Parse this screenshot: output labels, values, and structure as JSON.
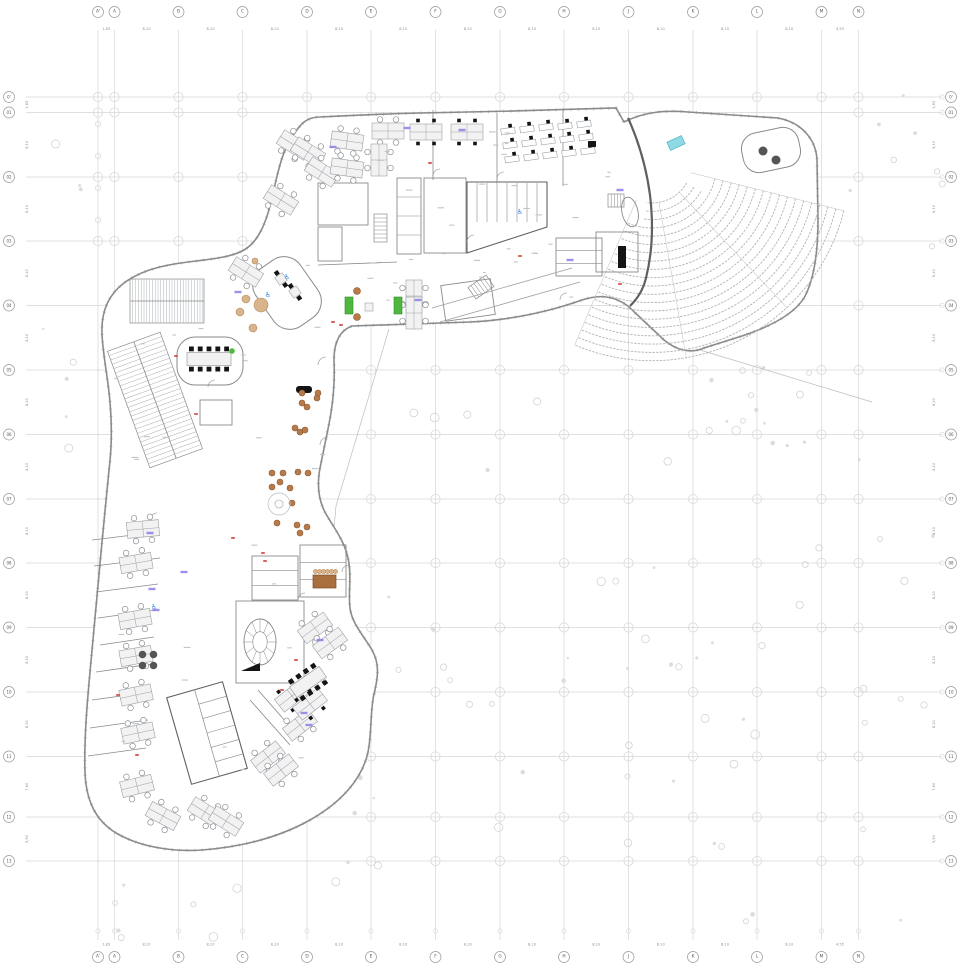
{
  "meta": {
    "drawing_type": "architectural floor plan"
  },
  "canvas": {
    "width": 960,
    "height": 965,
    "background": "#ffffff"
  },
  "colors": {
    "grid_line": "#d6d6d6",
    "grid_bubble_stroke": "#999999",
    "grid_text": "#555555",
    "dim_text": "#8f8f8f",
    "wall": "#8a8a8a",
    "wall_heavy": "#606060",
    "furniture_stroke": "#9aa0a6",
    "furniture_fill": "#f2f2f2",
    "black": "#141414",
    "seat_row": "#aeb4ba",
    "tick": "#909090",
    "site_dot": "#d3d3d3",
    "ring": "#d8d8d8",
    "sofa_green": "#4fb63f",
    "plant_green": "#4fb63f",
    "stage_cyan": "#8fd9e4",
    "stage_cyan_stroke": "#4ab5c4",
    "stool_brown": "#b97a4a",
    "stool_brown_stroke": "#8a5a33",
    "tan": "#d9b38c",
    "table_brown": "#a96f3d",
    "wheelchair_blue": "#2e86de",
    "label_blue": "#8a7fe8",
    "red_mark": "#d23b2f",
    "annotation": "#c3c3c3",
    "dark_circle": "#555555"
  },
  "grid": {
    "columns": {
      "labels": [
        "A'",
        "A",
        "B",
        "C",
        "D",
        "E",
        "F",
        "G",
        "H",
        "J",
        "K",
        "L",
        "M",
        "N"
      ],
      "x": [
        98,
        114.5,
        178.5,
        242.5,
        307,
        371,
        435.5,
        500,
        564,
        628.5,
        693,
        757,
        821.5,
        858.5
      ],
      "dims": [
        "1,83",
        "8,10",
        "8,10",
        "8,10",
        "8,10",
        "8,10",
        "8,10",
        "8,10",
        "8,10",
        "8,10",
        "8,10",
        "8,10",
        "4,55"
      ]
    },
    "rows": {
      "labels": [
        "0'",
        "01",
        "02",
        "03",
        "04",
        "05",
        "06",
        "07",
        "08",
        "09",
        "10",
        "11",
        "12",
        "13"
      ],
      "y": [
        97,
        112.5,
        177,
        241,
        305.5,
        370,
        434.5,
        499,
        563,
        627.5,
        692,
        756.5,
        817,
        861
      ],
      "dims": [
        "1,83",
        "8,10",
        "8,10",
        "8,10",
        "8,10",
        "8,10",
        "8,10",
        "8,10",
        "8,10",
        "8,10",
        "8,10",
        "7,60",
        "5,50"
      ]
    }
  },
  "auditorium": {
    "cx": 652,
    "cy": 163,
    "rows": 20,
    "r0": 40,
    "dr": 8.3,
    "a0": 14,
    "a1": 113,
    "a0_inner": 30,
    "a1_inner": 98,
    "aisle_angles": [
      14,
      47,
      80,
      113
    ]
  },
  "stage": {
    "x": 676,
    "y": 143,
    "w": 16,
    "h": 9,
    "rot": -25
  },
  "lobe_circles_dark": [
    [
      763,
      151,
      4.5
    ],
    [
      776,
      160,
      4.5
    ]
  ],
  "furniture": {
    "quad_circle": [
      [
        294,
        145,
        32
      ],
      [
        281,
        200,
        32
      ],
      [
        308,
        152,
        32
      ],
      [
        322,
        172,
        32
      ],
      [
        347,
        141,
        8
      ],
      [
        347,
        168,
        8
      ],
      [
        388,
        131,
        0
      ],
      [
        379,
        160,
        90
      ],
      [
        414,
        296,
        90
      ],
      [
        414,
        313,
        90
      ],
      [
        246,
        272,
        32
      ],
      [
        143,
        529,
        -5
      ],
      [
        136,
        563,
        -10
      ],
      [
        135,
        619,
        -10
      ],
      [
        136,
        656,
        -10
      ],
      [
        136,
        695,
        -12
      ],
      [
        138,
        733,
        -12
      ],
      [
        137,
        786,
        -14
      ],
      [
        163,
        816,
        28
      ],
      [
        205,
        812,
        32
      ],
      [
        226,
        821,
        32
      ],
      [
        315,
        628,
        -36
      ],
      [
        330,
        643,
        -36
      ],
      [
        300,
        725,
        -38
      ],
      [
        268,
        757,
        -38
      ],
      [
        281,
        770,
        -38
      ]
    ],
    "quad_black": [
      [
        426,
        132,
        0
      ],
      [
        467,
        132,
        0
      ],
      [
        292,
        696,
        -38
      ],
      [
        310,
        704,
        -38
      ]
    ],
    "singles_black": [
      [
        508,
        131,
        -8
      ],
      [
        527,
        129,
        -8
      ],
      [
        546,
        127,
        -8
      ],
      [
        565,
        126,
        -8
      ],
      [
        584,
        124,
        -8
      ],
      [
        510,
        145,
        -8
      ],
      [
        529,
        143,
        -8
      ],
      [
        548,
        141,
        -8
      ],
      [
        567,
        139,
        -8
      ],
      [
        586,
        137,
        -8
      ],
      [
        512,
        159,
        -8
      ],
      [
        531,
        157,
        -8
      ],
      [
        550,
        155,
        -8
      ],
      [
        569,
        153,
        -8
      ],
      [
        588,
        151,
        -8
      ]
    ],
    "meeting_rooms": [
      {
        "x": 209,
        "y": 359,
        "rot": 0,
        "w": 44,
        "h": 13,
        "chairs_per_side": 5
      },
      {
        "x": 308,
        "y": 682,
        "rot": -35,
        "w": 36,
        "h": 13,
        "chairs_per_side": 4
      }
    ],
    "mini_tables_black": [
      [
        281,
        279,
        -35
      ],
      [
        295,
        292,
        -35
      ]
    ],
    "circle4_tables": [
      [
        148,
        660
      ]
    ],
    "bench_black": {
      "x": 296,
      "y": 386,
      "w": 16,
      "h": 7
    },
    "black_wedge": [
      [
        241,
        671
      ],
      [
        260,
        663
      ],
      [
        260,
        671
      ]
    ],
    "elevators_black": [
      [
        618,
        246,
        8,
        22
      ],
      [
        588,
        141,
        8,
        6
      ]
    ]
  },
  "lounge": {
    "sofas_green": [
      [
        345,
        297,
        8,
        17
      ],
      [
        394,
        297,
        8,
        17
      ]
    ],
    "center_table": [
      365,
      303,
      8,
      8
    ],
    "brown_circles": [
      [
        357,
        291,
        3.5
      ],
      [
        357,
        317,
        3.5
      ]
    ]
  },
  "terrace": {
    "stools_brown": [
      [
        302,
        393,
        3
      ],
      [
        317,
        398,
        3
      ],
      [
        302,
        403,
        3
      ],
      [
        307,
        407,
        3
      ],
      [
        295,
        428,
        3
      ],
      [
        300,
        432,
        3
      ],
      [
        305,
        430,
        3
      ],
      [
        272,
        473,
        3
      ],
      [
        283,
        473,
        3
      ],
      [
        298,
        472,
        3
      ],
      [
        308,
        473,
        3
      ],
      [
        280,
        482,
        3
      ],
      [
        272,
        487,
        3
      ],
      [
        290,
        488,
        3
      ],
      [
        292,
        503,
        3
      ],
      [
        277,
        523,
        3
      ],
      [
        297,
        525,
        3
      ],
      [
        307,
        527,
        3
      ],
      [
        300,
        533,
        3
      ],
      [
        318,
        393,
        3
      ]
    ],
    "fountain": {
      "x": 279,
      "y": 504,
      "r": 11,
      "r2": 4
    },
    "cafe_table": {
      "x": 313,
      "y": 575,
      "w": 23,
      "h": 13
    },
    "cafe_cups": {
      "y": 571.5,
      "x0": 315.5,
      "step": 4,
      "n": 6,
      "r": 2.2
    },
    "tan_circles": [
      [
        246,
        299,
        4
      ],
      [
        240,
        312,
        4
      ],
      [
        253,
        328,
        4
      ],
      [
        255,
        261,
        3
      ],
      [
        261,
        305,
        7
      ]
    ],
    "plants_green": [
      [
        232,
        351,
        2.8
      ]
    ]
  },
  "icons": {
    "wheelchairs": [
      [
        287,
        277
      ],
      [
        268,
        295
      ],
      [
        154,
        607
      ],
      [
        520,
        212
      ]
    ]
  },
  "marks": {
    "red": [
      [
        333,
        322
      ],
      [
        341,
        325
      ],
      [
        233,
        538
      ],
      [
        263,
        553
      ],
      [
        265,
        561
      ],
      [
        176,
        356
      ],
      [
        196,
        414
      ],
      [
        282,
        690
      ],
      [
        296,
        660
      ],
      [
        430,
        163
      ],
      [
        520,
        256
      ],
      [
        118,
        695
      ],
      [
        137,
        755
      ],
      [
        620,
        284
      ]
    ],
    "blue_labels": [
      [
        407,
        128
      ],
      [
        462,
        130
      ],
      [
        333,
        147
      ],
      [
        238,
        292
      ],
      [
        150,
        533
      ],
      [
        152,
        589
      ],
      [
        156,
        610
      ],
      [
        184,
        572
      ],
      [
        304,
        713
      ],
      [
        309,
        725
      ],
      [
        320,
        640
      ],
      [
        418,
        300
      ],
      [
        570,
        260
      ],
      [
        620,
        190
      ]
    ]
  },
  "bike_racks": [
    {
      "cx": 167,
      "cy": 301,
      "w": 74,
      "h": 44,
      "rot": 0,
      "dir": "v",
      "step": 2.8
    },
    {
      "cx": 155,
      "cy": 400,
      "w": 56,
      "h": 124,
      "rot": -20,
      "dir": "h",
      "step": 4.6
    }
  ],
  "rooms": {
    "rects": [
      [
        318,
        183,
        50,
        42,
        0
      ],
      [
        318,
        227,
        24,
        34,
        0
      ],
      [
        397,
        178,
        24,
        76,
        0
      ],
      [
        424,
        178,
        42,
        75,
        0
      ],
      [
        556,
        238,
        46,
        38,
        0
      ],
      [
        596,
        232,
        42,
        40,
        0
      ],
      [
        252,
        556,
        46,
        44,
        0
      ],
      [
        300,
        545,
        46,
        52,
        0
      ],
      [
        236,
        601,
        68,
        82,
        0
      ],
      [
        200,
        400,
        32,
        25,
        0
      ],
      [
        443,
        282,
        50,
        36,
        -8
      ]
    ],
    "toilet_poly": [
      [
        467,
        182
      ],
      [
        547,
        182
      ],
      [
        547,
        227
      ],
      [
        467,
        253
      ]
    ],
    "stair_hatches": [
      [
        374,
        214,
        13,
        28,
        0,
        7,
        "h"
      ],
      [
        608,
        194,
        16,
        13,
        0,
        5,
        "v"
      ],
      [
        470,
        280,
        22,
        14,
        -35,
        6,
        "v"
      ]
    ],
    "partitions": [
      [
        433,
        110,
        433,
        180
      ],
      [
        497,
        113,
        497,
        183
      ],
      [
        563,
        110,
        563,
        186
      ],
      [
        318,
        265,
        397,
        262
      ],
      [
        92,
        540,
        158,
        532
      ],
      [
        94,
        566,
        160,
        558
      ],
      [
        96,
        592,
        158,
        584
      ],
      [
        98,
        618,
        156,
        610
      ],
      [
        100,
        645,
        154,
        637
      ],
      [
        96,
        672,
        152,
        664
      ],
      [
        92,
        700,
        150,
        692
      ],
      [
        90,
        728,
        148,
        720
      ],
      [
        88,
        756,
        146,
        748
      ],
      [
        258,
        690,
        300,
        738
      ],
      [
        250,
        700,
        290,
        745
      ]
    ],
    "rounded_rooms": [
      {
        "cx": 287,
        "cy": 293,
        "w": 54,
        "h": 70,
        "rot": -35,
        "rx": 20
      },
      {
        "cx": 210,
        "cy": 361,
        "w": 66,
        "h": 48,
        "rot": 0,
        "rx": 18
      },
      {
        "cx": 771,
        "cy": 150,
        "w": 58,
        "h": 40,
        "rot": -12,
        "rx": 16
      }
    ],
    "oval_stair": {
      "cx": 260,
      "cy": 642,
      "rx": 16,
      "ry": 23
    },
    "oval_room": {
      "cx": 630,
      "cy": 212,
      "rx": 8,
      "ry": 15,
      "rot": -12
    },
    "toilet_core": {
      "cx": 207,
      "cy": 733,
      "w": 58,
      "h": 90,
      "rot": -16
    },
    "doors": [
      [
        318,
        365,
        8
      ],
      [
        320,
        445,
        8
      ],
      [
        433,
        176,
        7
      ],
      [
        497,
        179,
        7
      ],
      [
        467,
        242,
        7
      ],
      [
        208,
        387,
        7
      ],
      [
        298,
        600,
        7
      ],
      [
        342,
        572,
        7
      ],
      [
        560,
        300,
        7
      ],
      [
        150,
        520,
        7
      ]
    ]
  },
  "site": {
    "seed": 11,
    "regions": [
      [
        400,
        370,
        545,
        560,
        55
      ],
      [
        340,
        560,
        60,
        370,
        8
      ],
      [
        35,
        110,
        60,
        350,
        9
      ],
      [
        100,
        872,
        240,
        70,
        8
      ],
      [
        835,
        90,
        108,
        270,
        8
      ],
      [
        625,
        360,
        195,
        90,
        10
      ]
    ]
  },
  "annotations": {
    "seed": 5,
    "regions": [
      [
        300,
        130,
        310,
        170,
        22
      ],
      [
        110,
        300,
        220,
        540,
        26
      ],
      [
        430,
        180,
        180,
        120,
        12
      ]
    ]
  }
}
